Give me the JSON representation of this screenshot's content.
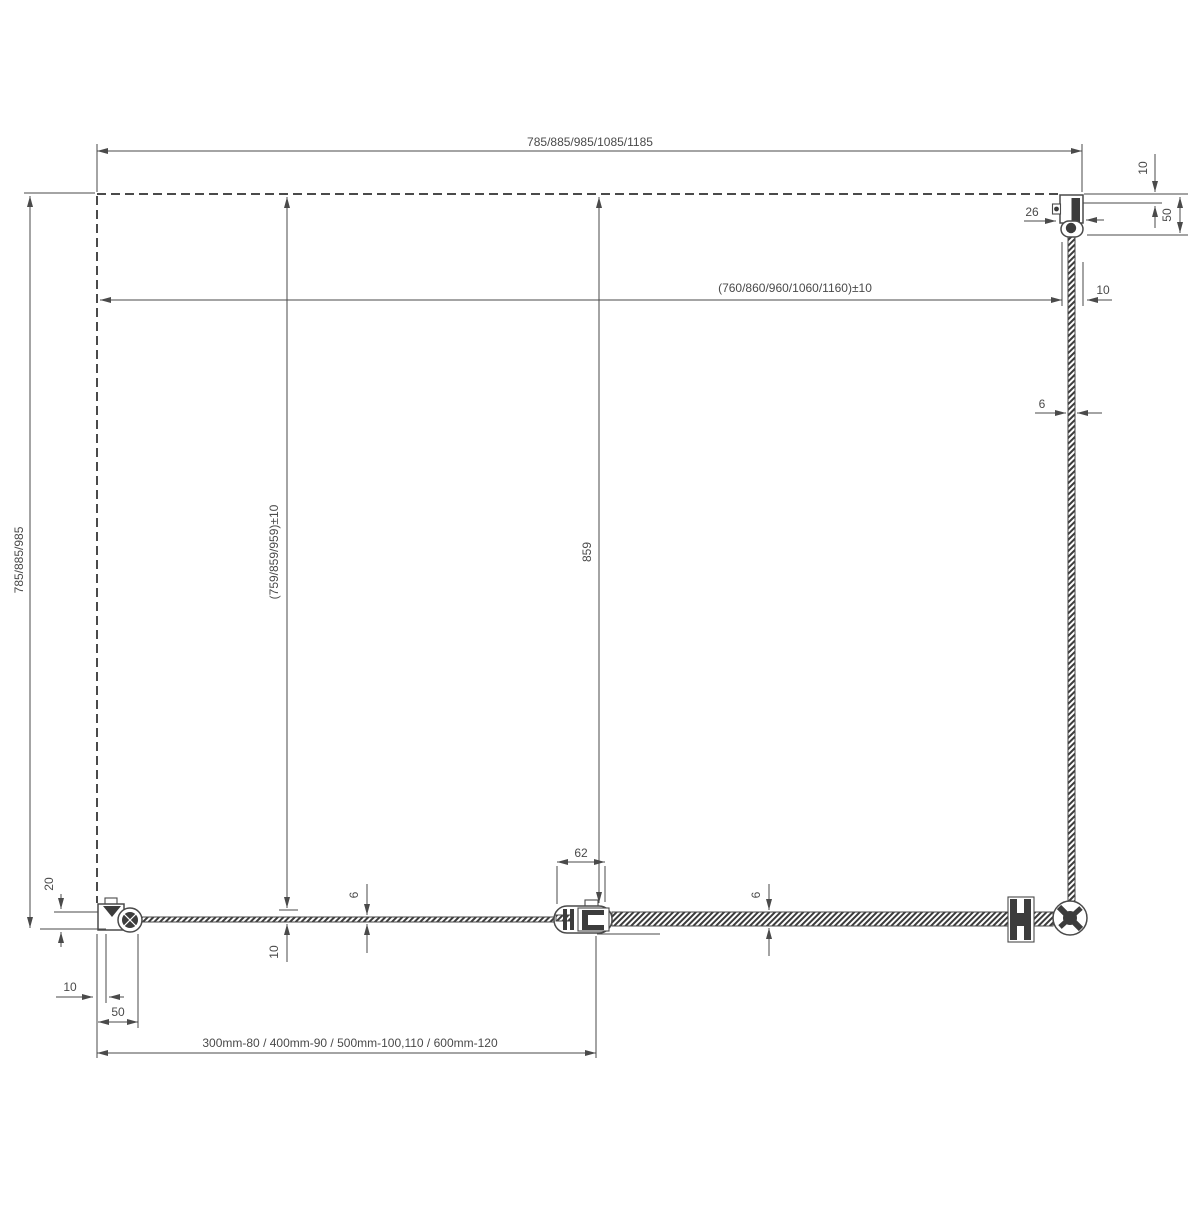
{
  "colors": {
    "line": "#4a4a4a",
    "dark_fill": "#3c3c3c",
    "background": "#ffffff"
  },
  "labels": {
    "top_width": "785/885/985/1085/1185",
    "inner_width": "(760/860/960/1060/1160)±10",
    "inner_width_offset": "10",
    "top_right_wall_gap": "10",
    "top_right_profile_depth": "50",
    "top_profile_width": "26",
    "side_glass_thickness": "6",
    "left_height": "785/885/985",
    "fixed_panel_height": "(759/859/959)±10",
    "door_width": "859",
    "connector_width": "62",
    "fixed_glass_thickness": "6",
    "door_glass_thickness": "6",
    "fixed_glass_gap": "10",
    "wall_clearance": "20",
    "bottom_wall_gap": "10",
    "bottom_profile_width": "50",
    "extension_profiles": "300mm-80 / 400mm-90 / 500mm-100,110 / 600mm-120"
  }
}
